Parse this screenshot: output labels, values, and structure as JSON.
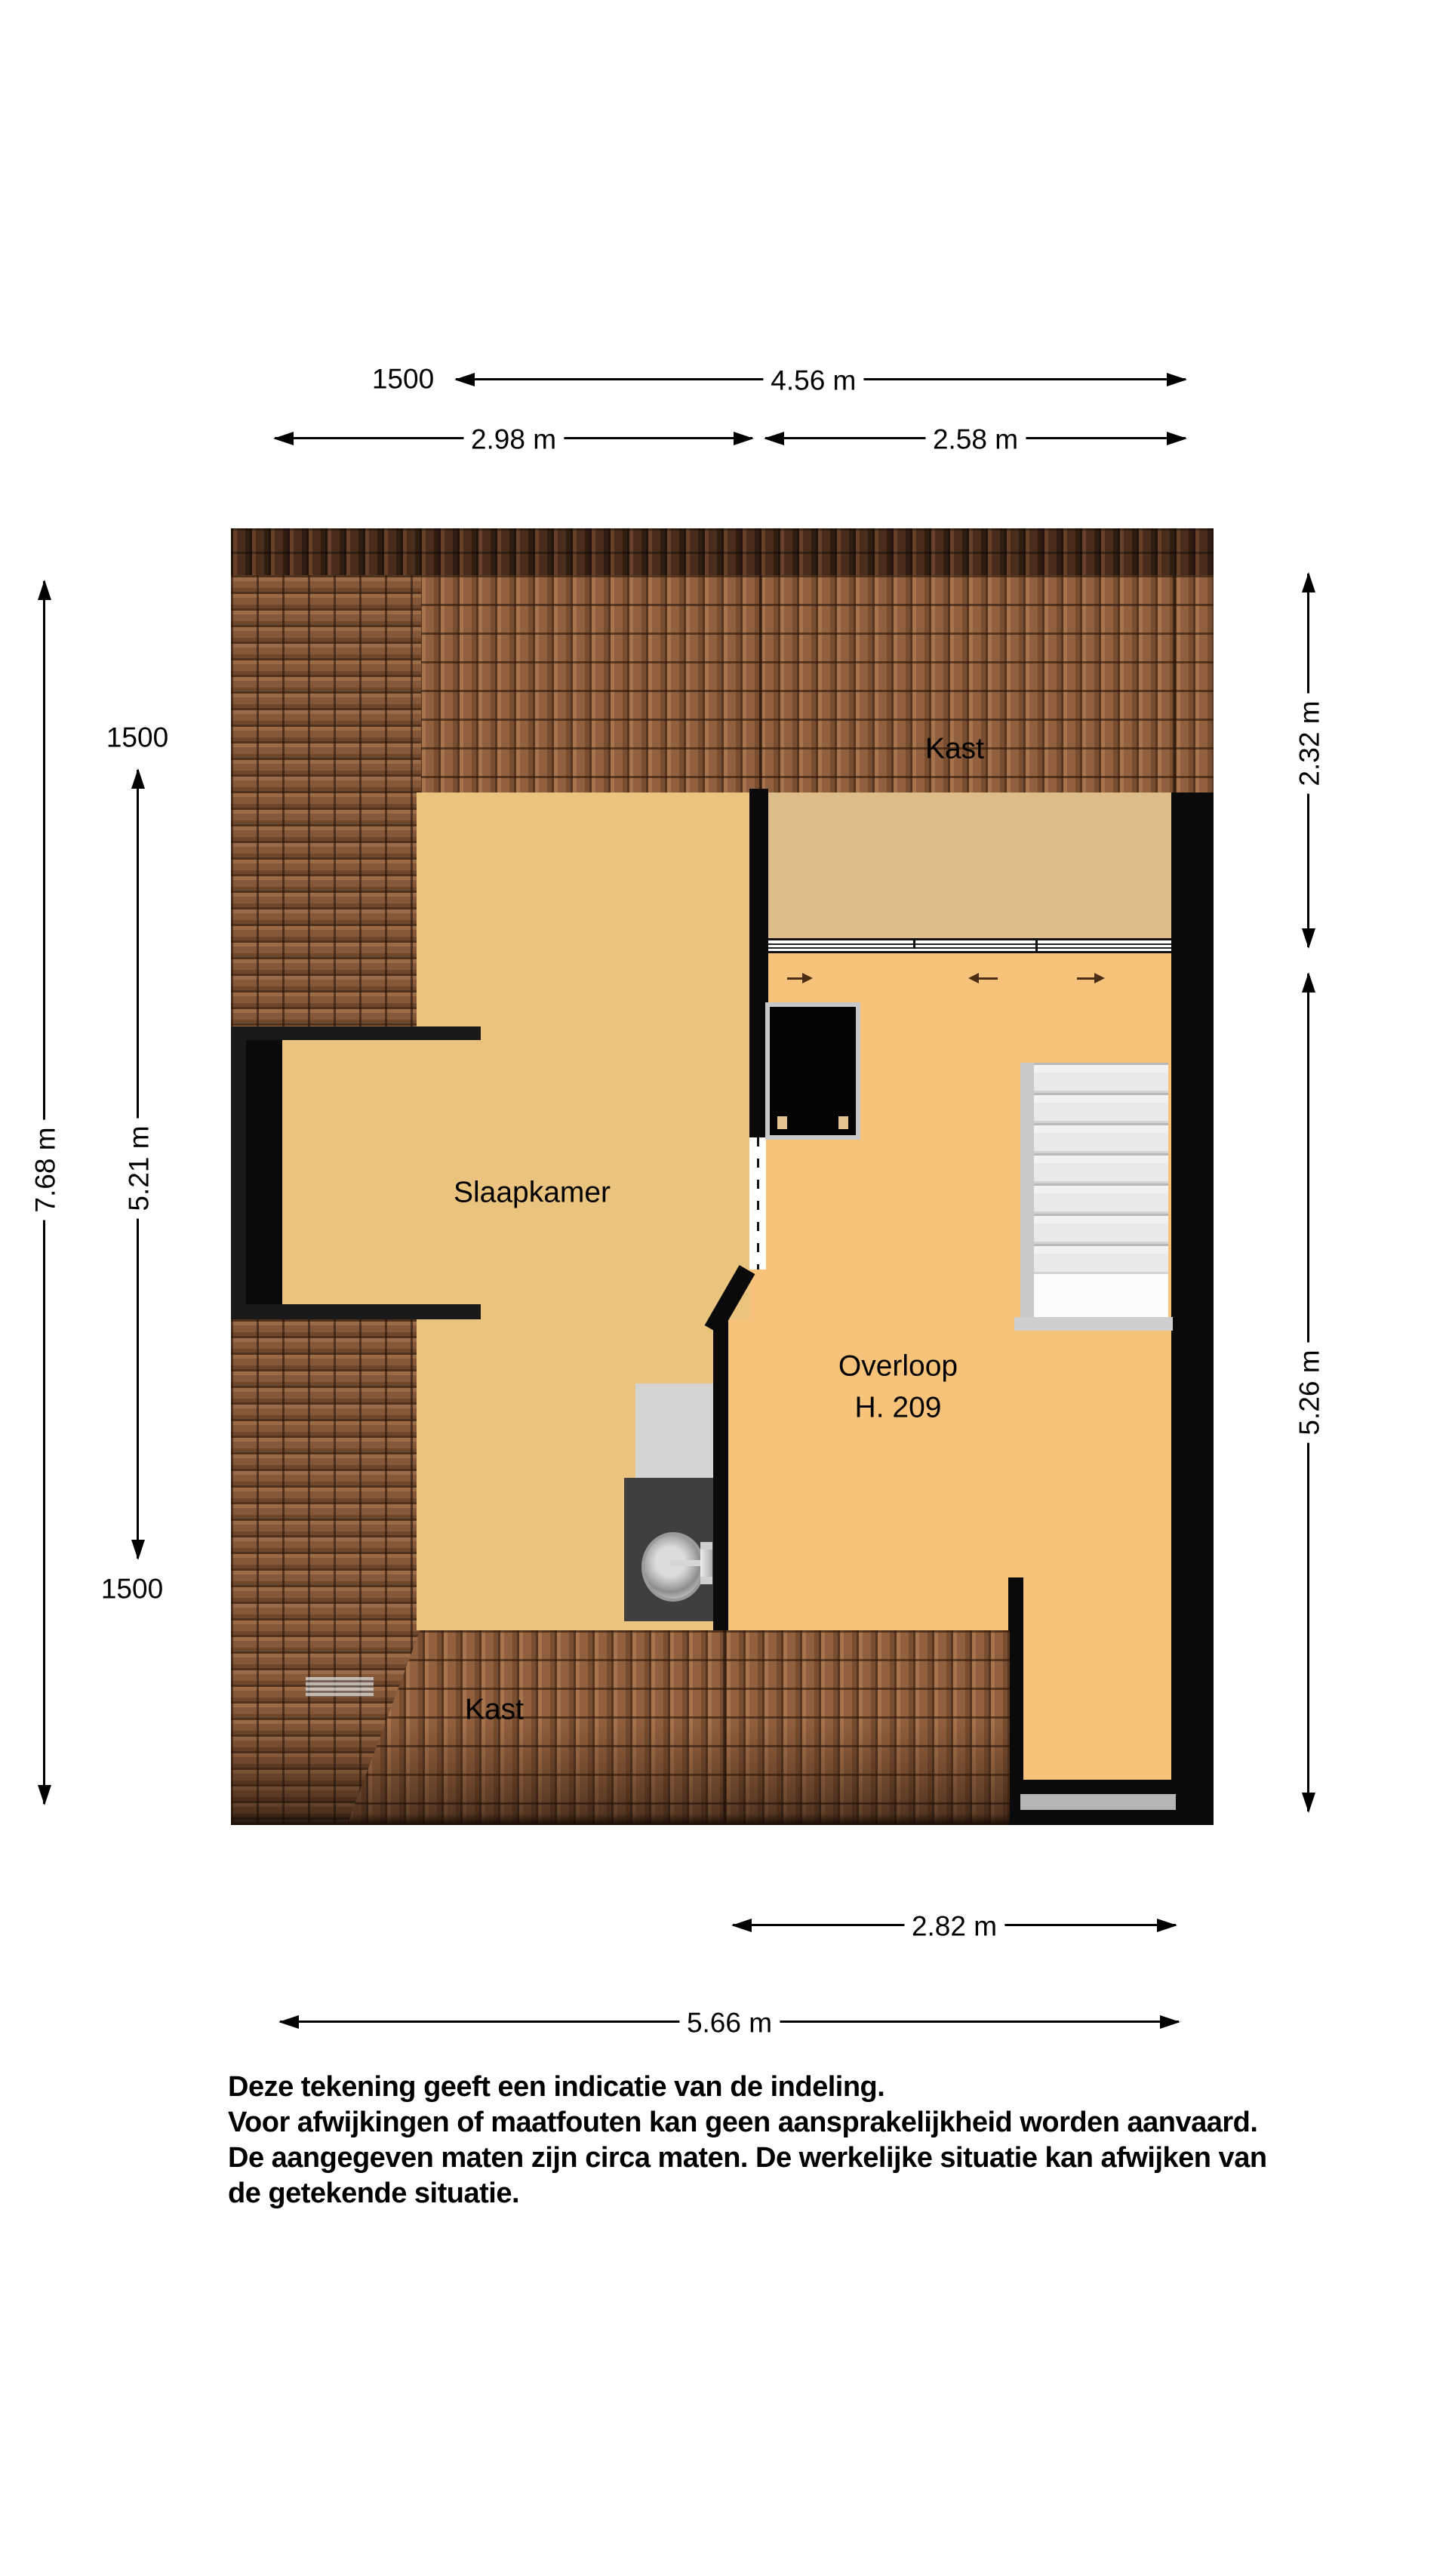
{
  "rooms": {
    "kast_top": "Kast",
    "slaapkamer": "Slaapkamer",
    "overloop": "Overloop",
    "overloop_code": "H. 209",
    "kast_bottom": "Kast"
  },
  "dimensions": {
    "top_code": "1500",
    "top_total": "4.56 m",
    "top_left": "2.98 m",
    "top_right": "2.58 m",
    "left_total": "7.68 m",
    "left_inner": "5.21 m",
    "left_code_top": "1500",
    "left_code_bottom": "1500",
    "right_upper": "2.32 m",
    "right_lower": "5.26 m",
    "bottom_inner": "2.82 m",
    "bottom_total": "5.66 m"
  },
  "disclaimer": {
    "line1": "Deze tekening geeft een indicatie van de indeling.",
    "line2": "Voor  afwijkingen of maatfouten kan geen aansprakelijkheid worden aanvaard.",
    "line3": "De aangegeven maten zijn circa maten. De werkelijke situatie kan afwijken van",
    "line4": "de getekende situatie."
  },
  "colors": {
    "floor_slaapkamer": "#eac47f",
    "floor_kast": "#dcbd89",
    "floor_overloop": "#f7c279",
    "wall": "#0a0a0a",
    "wall_dark": "#191919",
    "roof_mid": "#91603e",
    "roof_ridge": "#4a2c1c",
    "counter": "#d4d4d4",
    "cabinet": "#3f3f3f",
    "stairs": "#ededed",
    "stairs_edge": "#c9c9c9",
    "balcony_gray": "#b5b5b5",
    "arrow_brown": "#4a2e16",
    "ink": "#000000",
    "paper": "#ffffff"
  }
}
